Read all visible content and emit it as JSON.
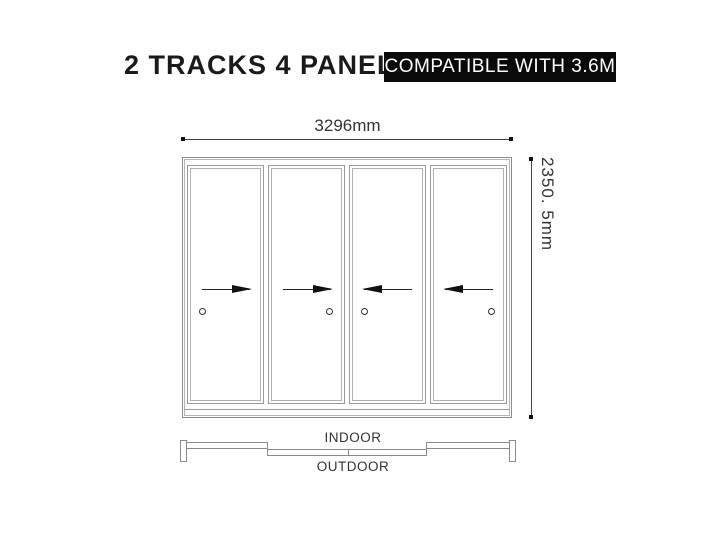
{
  "header": {
    "title": "2 TRACKS 4 PANELS",
    "badge": "COMPATIBLE WITH 3.6M"
  },
  "dimensions": {
    "width_label": "3296mm",
    "height_label": "2350. 5mm"
  },
  "plan_view": {
    "indoor_label": "INDOOR",
    "outdoor_label": "OUTDOOR"
  },
  "panels": [
    {
      "slide_direction": "right",
      "handle_side": "left"
    },
    {
      "slide_direction": "right",
      "handle_side": "right"
    },
    {
      "slide_direction": "left",
      "handle_side": "left"
    },
    {
      "slide_direction": "left",
      "handle_side": "right"
    }
  ],
  "colors": {
    "title_text": "#1a1a1a",
    "badge_bg": "#0a0a0a",
    "badge_text": "#ffffff",
    "frame_line": "#8a8a8a",
    "dimension_line": "#444444",
    "arrow": "#111111"
  }
}
